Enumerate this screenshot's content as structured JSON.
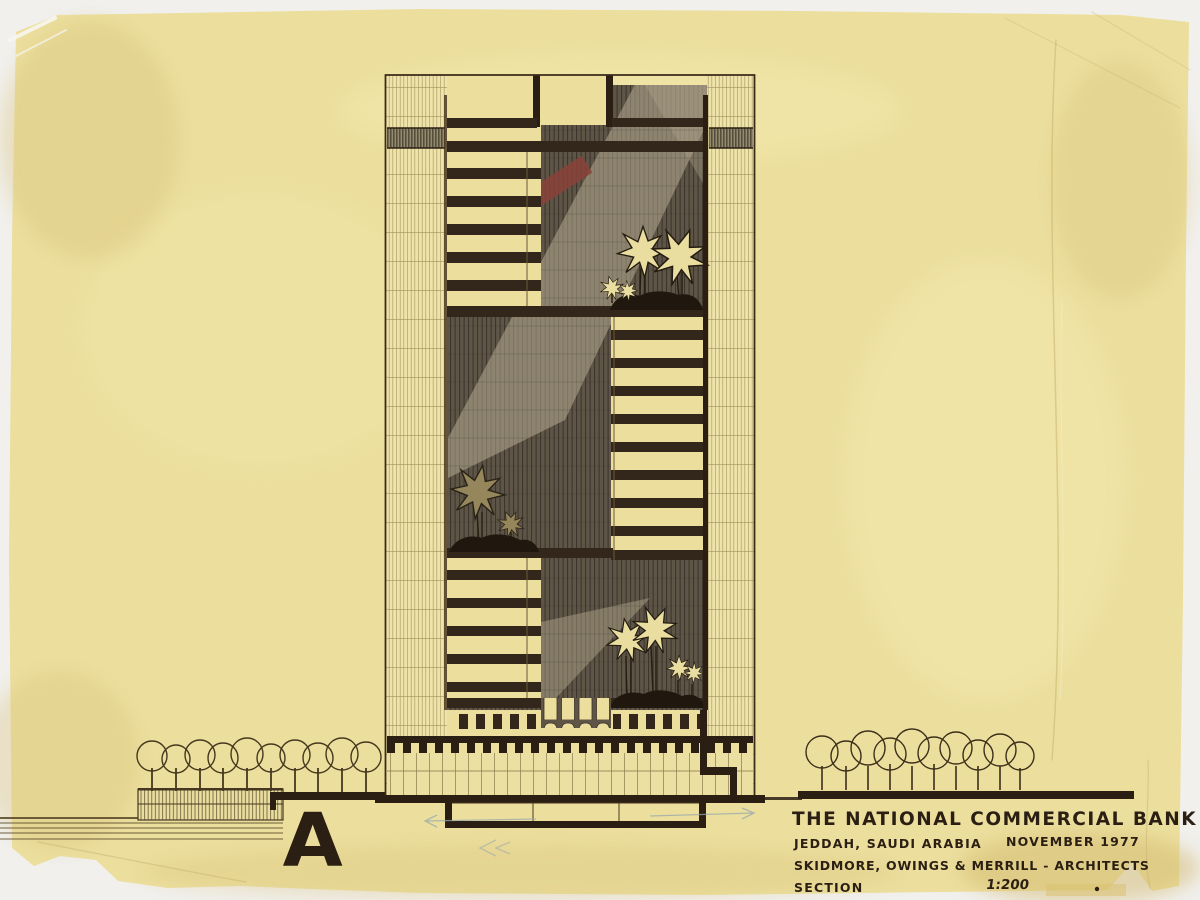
{
  "title_block": {
    "project": "THE NATIONAL COMMERCIAL BANK",
    "location": "JEDDAH, SAUDI ARABIA",
    "date": "NOVEMBER 1977",
    "architects": "SKIDMORE, OWINGS & MERRILL - ARCHITECTS",
    "drawing_type": "SECTION",
    "scale": "1:200"
  },
  "annotations": {
    "section_marker": "A"
  },
  "colors": {
    "paper": "#ecdf9e",
    "ink": "#2a1f12",
    "floor_slab": "#32271a",
    "atrium_shade": "#5e5547",
    "light_shaft": "#b5aa8f",
    "accent_red": "#8a4339",
    "pencil_blue": "#97a8ab"
  }
}
